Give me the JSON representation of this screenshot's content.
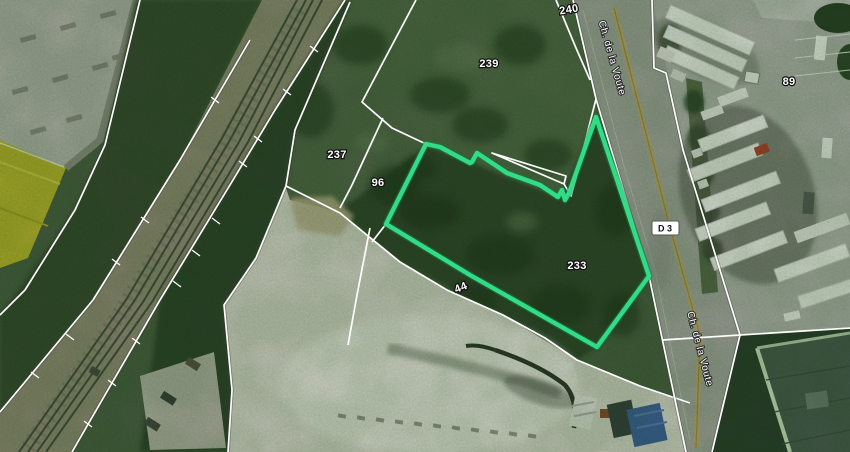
{
  "map": {
    "view_type": "aerial-cadastre",
    "highlight": {
      "parcel": "233",
      "color": "#32db86"
    },
    "cadastre_line_color": "#ffffff",
    "parcels": {
      "p240": "240",
      "p239": "239",
      "p237": "237",
      "p96": "96",
      "p233": "233",
      "p44": "44",
      "p89": "89"
    },
    "roads": {
      "name_top": "Ch. de la Voute",
      "name_bottom": "Ch. de la Voute",
      "badge": "D 3"
    }
  }
}
